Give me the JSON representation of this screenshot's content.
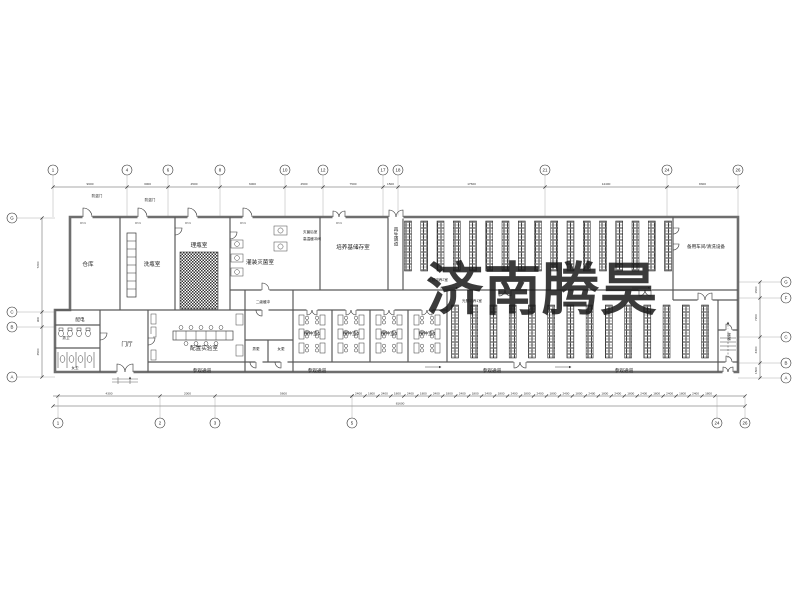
{
  "watermark": {
    "text": "济南腾昊",
    "color": "#e35054"
  },
  "drawing": {
    "rooms": {
      "warehouse": "仓库",
      "bottle_wash": "洗瓶室",
      "bottle_sort": "理瓶室",
      "fill_sterilize": "灌装灭菌室",
      "medium_storage": "培养基储存室",
      "regen_corridor": "再生通道",
      "spare_workshop": "备用车间/清洗设备",
      "light_culture_2": "光照培养2室",
      "light_culture_1": "光照培养1室",
      "power_room": "配电",
      "male_wc": "男卫",
      "female_wc": "女卫",
      "entry_hall": "门厅",
      "prep_lab": "配置实验室",
      "buffer_2": "二级缓冲",
      "male_change": "男更",
      "female_change": "女更",
      "inoc_1": "接种室1",
      "inoc_2": "接种室2",
      "inoc_3": "接种室3",
      "inoc_4": "接种室4",
      "visit_corridor": "参观通道",
      "stairs": "楼梯",
      "post_sterilize": "灭菌后室",
      "ht_buffer": "高温缓冲间",
      "security_door": "防盗门",
      "door_tag": "M721"
    },
    "grid": {
      "top": [
        {
          "label": "1",
          "x": 53
        },
        {
          "label": "4",
          "x": 127
        },
        {
          "label": "6",
          "x": 168
        },
        {
          "label": "8",
          "x": 220
        },
        {
          "label": "10",
          "x": 285
        },
        {
          "label": "12",
          "x": 323
        },
        {
          "label": "17",
          "x": 383
        },
        {
          "label": "18",
          "x": 398
        },
        {
          "label": "21",
          "x": 545
        },
        {
          "label": "24",
          "x": 667
        },
        {
          "label": "26",
          "x": 738
        }
      ],
      "bottom": [
        {
          "label": "1",
          "x": 58
        },
        {
          "label": "2",
          "x": 160
        },
        {
          "label": "3",
          "x": 215
        },
        {
          "label": "5",
          "x": 352
        },
        {
          "label": "24",
          "x": 717
        },
        {
          "label": "26",
          "x": 745
        }
      ],
      "left": [
        {
          "label": "G",
          "y": 218
        },
        {
          "label": "C",
          "y": 312
        },
        {
          "label": "B",
          "y": 327
        },
        {
          "label": "A",
          "y": 377
        }
      ],
      "right": [
        {
          "label": "G",
          "y": 282
        },
        {
          "label": "F",
          "y": 298
        },
        {
          "label": "C",
          "y": 337
        },
        {
          "label": "B",
          "y": 363
        },
        {
          "label": "A",
          "y": 378
        }
      ]
    },
    "dims": {
      "top": [
        "9600",
        "3000",
        "4500",
        "6000",
        "4500",
        "7500",
        "1500",
        "17500",
        "14400",
        "8300"
      ],
      "bottom_left": [
        "4300",
        "2000",
        "5600"
      ],
      "bottom_total": "81600",
      "colonnade": [
        "2400",
        "1800"
      ],
      "left": [
        "7200",
        "900",
        "4500"
      ],
      "right": [
        "1500",
        "7200",
        "3300",
        "1500"
      ]
    },
    "racks": {
      "top_columns": 17,
      "bottom_columns": 14
    }
  }
}
